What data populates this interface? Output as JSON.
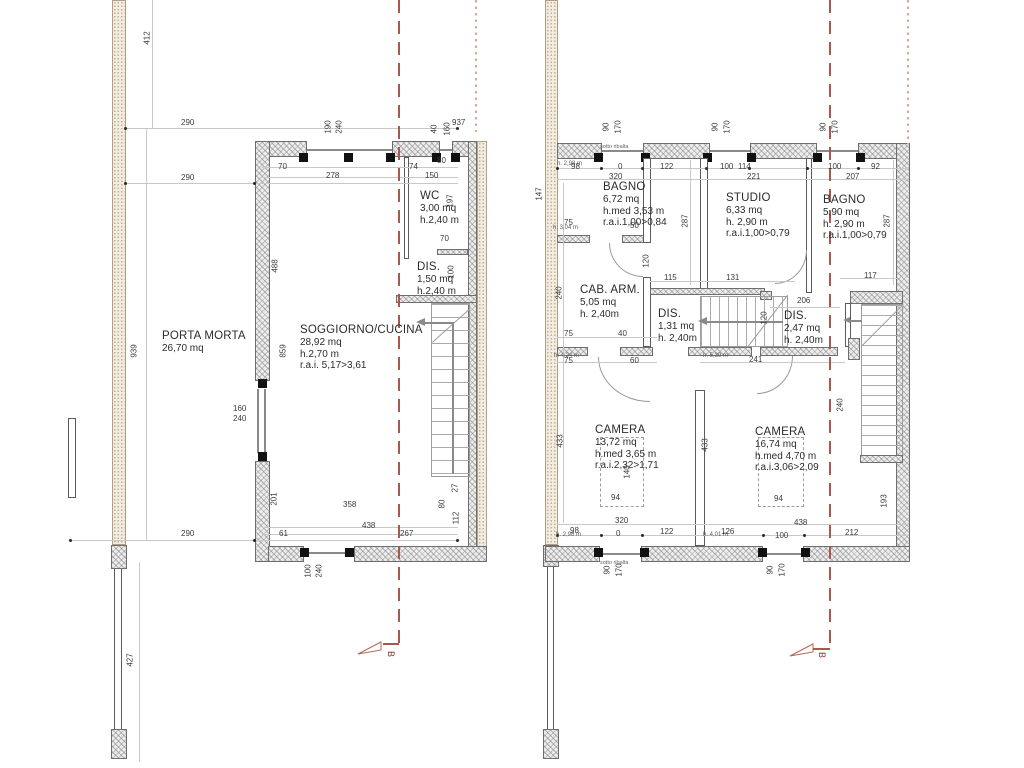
{
  "drawing_title": "floor-plans",
  "colors": {
    "wall_fill": "#ededed",
    "wall_hatch": "#7d7d7d",
    "neighbor_wall_fill": "#f2ede2",
    "neighbor_wall_dots": "#c6b094",
    "dimension_text": "#3a3a3a",
    "dimension_line": "#c8c8c8",
    "section_line": "#a8584c",
    "boundary_dotted_line": "#dca79a",
    "section_letter": "#7d2f2a"
  },
  "left_plan": {
    "rooms": {
      "porta_morta": {
        "name": "PORTA MORTA",
        "area": "26,70 mq"
      },
      "soggiorno": {
        "name": "SOGGIORNO/CUCINA",
        "area": "28,92 mq",
        "height": "h.2,70 m",
        "rai": "r.a.i. 5,17>3,61"
      },
      "wc": {
        "name": "WC",
        "area": "3,00 mq",
        "height": "h.2,40 m"
      },
      "dis": {
        "name": "DIS.",
        "area": "1,50 mq",
        "height": "h.2,40 m"
      }
    },
    "dims": [
      "412",
      "290",
      "290",
      "190",
      "240",
      "40",
      "160",
      "937",
      "70",
      "278",
      "74",
      "80",
      "150",
      "197",
      "70",
      "100",
      "488",
      "939",
      "859",
      "160",
      "240",
      "201",
      "358",
      "27",
      "80",
      "112",
      "438",
      "61",
      "267",
      "290",
      "100",
      "240",
      "427"
    ],
    "section_letter": "B"
  },
  "right_plan": {
    "rooms": {
      "bagno1": {
        "name": "BAGNO",
        "area": "6,72 mq",
        "height": "h.med 3,53 m",
        "rai": "r.a.i.1,00>0,84"
      },
      "studio": {
        "name": "STUDIO",
        "area": "6,33 mq",
        "height": "h. 2,90 m",
        "rai": "r.a.i.1,00>0,79"
      },
      "bagno2": {
        "name": "BAGNO",
        "area": "5,90 mq",
        "height": "h. 2,90 m",
        "rai": "r.a.i.1,00>0,79"
      },
      "cab_arm": {
        "name": "CAB. ARM.",
        "area": "5,05 mq",
        "height": "h. 2,40m"
      },
      "dis1": {
        "name": "DIS.",
        "area": "1,31 mq",
        "height": "h. 2,40m"
      },
      "dis2": {
        "name": "DIS.",
        "area": "2,47 mq",
        "height": "h. 2,40m"
      },
      "camera1": {
        "name": "CAMERA",
        "area": "13,72 mq",
        "height": "h.med 3,65 m",
        "rai": "r.a.i.2,32>1,71"
      },
      "camera2": {
        "name": "CAMERA",
        "area": "16,74 mq",
        "height": "h.med 4,70 m",
        "rai": "r.a.i.3,06>2,09"
      }
    },
    "dims": [
      "90",
      "170",
      "90",
      "170",
      "90",
      "170",
      "h. 2,98 m",
      "98",
      "0",
      "122",
      "320",
      "100",
      "114",
      "221",
      "100",
      "92",
      "207",
      "147",
      "287",
      "287",
      "h. 3,04 m",
      "75",
      "50",
      "120",
      "240",
      "115",
      "131",
      "75",
      "40",
      "h. 4,24 m",
      "75",
      "60",
      "h. 5,39 m",
      "241",
      "206",
      "117",
      "120",
      "433",
      "433",
      "140",
      "94",
      "94",
      "240",
      "193",
      "320",
      "h. 2,98 m",
      "98",
      "0",
      "122",
      "h. 4,01 m",
      "126",
      "100",
      "438",
      "212",
      "90",
      "170",
      "90",
      "170"
    ],
    "annotations": [
      "sotto ribalta",
      "sotto ribalta"
    ],
    "section_letter": "B"
  }
}
